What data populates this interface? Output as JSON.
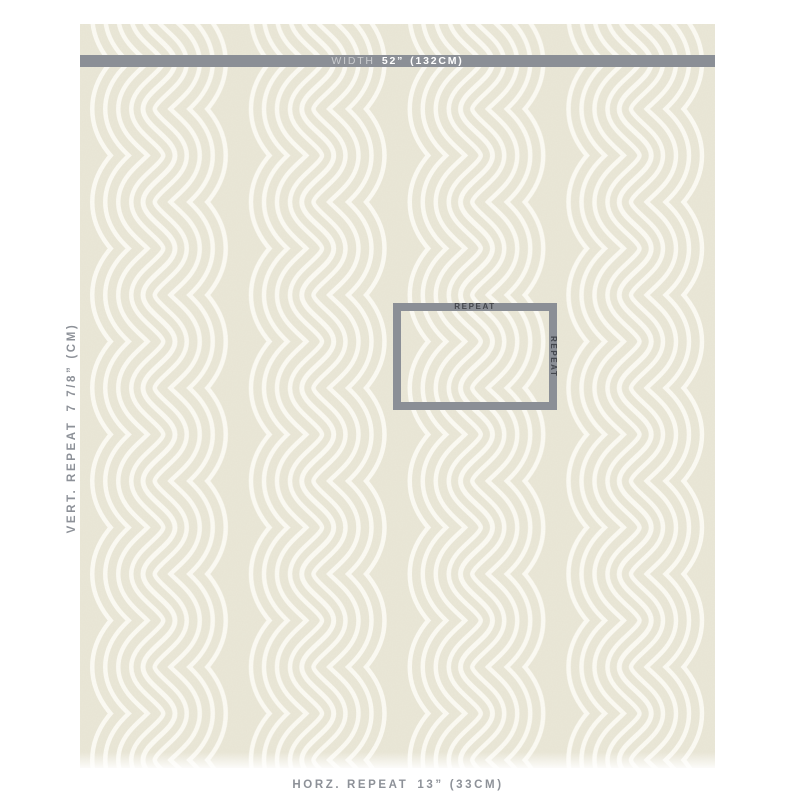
{
  "swatch": {
    "pattern_name": "zen-scroll-wave-fabric",
    "base_color": "#eae7d7",
    "line_color": "#fcfbf4"
  },
  "width_bar": {
    "bar_color": "#8b8f96",
    "label": "WIDTH",
    "value": "52”",
    "metric": "(132CM)"
  },
  "repeat_box": {
    "border_color": "#8b8f96",
    "label_color": "#43464c",
    "top_label": "REPEAT",
    "side_label": "REPEAT"
  },
  "vertical_repeat": {
    "label": "VERT. REPEAT",
    "value": "7 7/8”",
    "metric": "(CM)"
  },
  "horizontal_repeat": {
    "label": "HORZ. REPEAT",
    "value": "13”",
    "metric": "(33CM)"
  }
}
